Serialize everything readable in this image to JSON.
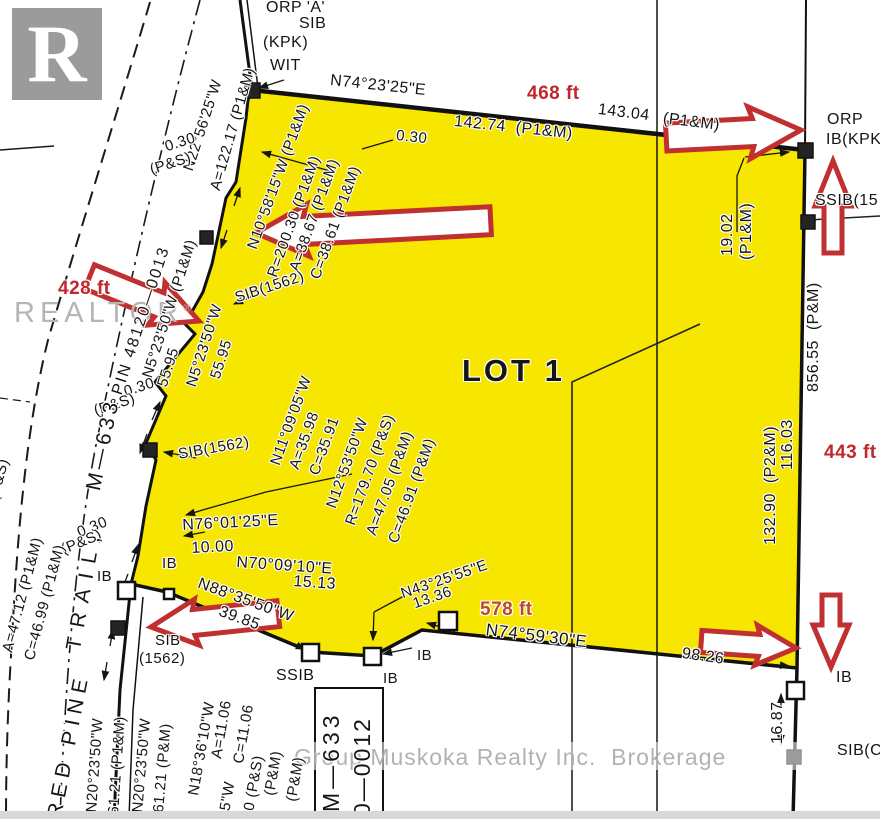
{
  "title": "Survey plan - LOT 1 (Red Pine Trail, M-633)",
  "logo": {
    "letter": "R",
    "brand": "REALTOR",
    "registered": "®"
  },
  "watermark": {
    "text": "Group Muskoka Realty Inc.  Brokerage"
  },
  "colors": {
    "lot_yellow": "#f7e600",
    "arrow_red": "#c13030",
    "dist_red": "#c2272d",
    "dist_orange": "#bd4a22",
    "line_black": "#1a1a1a",
    "watermark_gray": "#aeaeae",
    "logo_gray": "#9b9b9b"
  },
  "icons": [
    "red-arrow-left-top",
    "red-arrow-right-top",
    "red-arrow-up-right",
    "red-arrow-right-428",
    "red-arrow-left-bottom",
    "red-arrow-right-bottom",
    "red-arrow-down-right",
    "realtor-logo"
  ],
  "lot": {
    "name": "LOT 1"
  },
  "labels": [
    {
      "t": "ORP 'A'",
      "x": 266,
      "y": 0,
      "r": 0,
      "s": 16
    },
    {
      "t": "SIB",
      "x": 299,
      "y": 16,
      "r": 0,
      "s": 16
    },
    {
      "t": "(KPK)",
      "x": 263,
      "y": 35,
      "r": 0,
      "s": 16
    },
    {
      "t": "WIT",
      "x": 270,
      "y": 58,
      "r": 0,
      "s": 16
    },
    {
      "t": "N74°23'25\"E",
      "x": 331,
      "y": 73,
      "r": 6,
      "s": 16
    },
    {
      "t": "468 ft",
      "x": 527,
      "y": 84,
      "r": 0,
      "s": 19,
      "w": 700,
      "c": "red"
    },
    {
      "t": "142.74  (P1&M)",
      "x": 455,
      "y": 114,
      "r": 6,
      "s": 16
    },
    {
      "t": "143.04",
      "x": 599,
      "y": 102,
      "r": 7,
      "s": 16
    },
    {
      "t": "(P1&M)",
      "x": 664,
      "y": 111,
      "r": 7,
      "s": 16
    },
    {
      "t": "ORP",
      "x": 827,
      "y": 112,
      "r": 0,
      "s": 16
    },
    {
      "t": "IB(KPK",
      "x": 826,
      "y": 132,
      "r": 0,
      "s": 16
    },
    {
      "t": "SSIB(15",
      "x": 815,
      "y": 193,
      "r": 0,
      "s": 16
    },
    {
      "t": "0.30",
      "x": 397,
      "y": 128,
      "r": 6,
      "s": 15
    },
    {
      "t": "N22°56'25\"W",
      "x": 181,
      "y": 168,
      "r": -72,
      "s": 15
    },
    {
      "t": "A=122.17 (P1&M)",
      "x": 208,
      "y": 188,
      "r": -74,
      "s": 15
    },
    {
      "t": "0.30",
      "x": 163,
      "y": 140,
      "r": -18,
      "s": 15
    },
    {
      "t": "(P&S)",
      "x": 148,
      "y": 163,
      "r": -18,
      "s": 15
    },
    {
      "t": "PIN 48120—0013",
      "x": 110,
      "y": 392,
      "r": -72,
      "s": 16,
      "ls": 2
    },
    {
      "t": "N10°58'15\"W (P1&M)",
      "x": 245,
      "y": 246,
      "r": -70,
      "s": 15
    },
    {
      "t": "R=200.30 (P1&M)",
      "x": 265,
      "y": 274,
      "r": -70,
      "s": 15
    },
    {
      "t": "A=38.67 (P1&M)",
      "x": 287,
      "y": 268,
      "r": -70,
      "s": 15
    },
    {
      "t": "C=38.61 (P1&M)",
      "x": 308,
      "y": 276,
      "r": -70,
      "s": 15
    },
    {
      "t": "SIB(1562)",
      "x": 233,
      "y": 291,
      "r": -18,
      "s": 15
    },
    {
      "t": "428 ft",
      "x": 58,
      "y": 279,
      "r": 0,
      "s": 19,
      "w": 700,
      "c": "red"
    },
    {
      "t": "N5°23'50\"W (P1&M)",
      "x": 140,
      "y": 375,
      "r": -72,
      "s": 15
    },
    {
      "t": "55.95",
      "x": 155,
      "y": 384,
      "r": -72,
      "s": 15
    },
    {
      "t": "N5°23'50\"W",
      "x": 184,
      "y": 384,
      "r": -72,
      "s": 15
    },
    {
      "t": "55.95",
      "x": 208,
      "y": 376,
      "r": -72,
      "s": 15
    },
    {
      "t": "0.30",
      "x": 122,
      "y": 385,
      "r": -18,
      "s": 15
    },
    {
      "t": "(P&S)",
      "x": 92,
      "y": 404,
      "r": -18,
      "s": 15
    },
    {
      "t": "0.30",
      "x": 75,
      "y": 526,
      "r": -22,
      "s": 15
    },
    {
      "t": "(P&S)",
      "x": 59,
      "y": 543,
      "r": -22,
      "s": 15
    },
    {
      "t": "(P&S)",
      "x": -14,
      "y": 498,
      "r": -75,
      "s": 15
    },
    {
      "t": "A=47.12 (P1&M)",
      "x": 0,
      "y": 650,
      "r": -75,
      "s": 15
    },
    {
      "t": "C=46.99 (P1&M)",
      "x": 22,
      "y": 658,
      "r": -75,
      "s": 15
    },
    {
      "t": "RED PINE",
      "x": 44,
      "y": 816,
      "r": -79,
      "s": 21,
      "ls": 6
    },
    {
      "t": "TRAIL,",
      "x": 63,
      "y": 648,
      "r": -80,
      "s": 21,
      "ls": 10
    },
    {
      "t": "M—633",
      "x": 83,
      "y": 488,
      "r": -78,
      "s": 21,
      "ls": 4
    },
    {
      "t": "SIB(1562)",
      "x": 177,
      "y": 447,
      "r": -10,
      "s": 15
    },
    {
      "t": "N11°09'05\"W",
      "x": 268,
      "y": 462,
      "r": -70,
      "s": 15
    },
    {
      "t": "A=35.98",
      "x": 287,
      "y": 466,
      "r": -70,
      "s": 15
    },
    {
      "t": "C=35.91",
      "x": 307,
      "y": 472,
      "r": -70,
      "s": 15
    },
    {
      "t": "N12°53'50\"W",
      "x": 324,
      "y": 505,
      "r": -70,
      "s": 15
    },
    {
      "t": "R=179.70 (P&S)",
      "x": 343,
      "y": 522,
      "r": -70,
      "s": 15
    },
    {
      "t": "A=47.05 (P&M)",
      "x": 364,
      "y": 532,
      "r": -70,
      "s": 15
    },
    {
      "t": "C=46.91 (P&M)",
      "x": 386,
      "y": 540,
      "r": -70,
      "s": 15
    },
    {
      "t": "LOT 1",
      "x": 462,
      "y": 355,
      "r": 0,
      "s": 31,
      "w": 700,
      "ls": 3
    },
    {
      "t": "19.02",
      "x": 720,
      "y": 256,
      "r": -90,
      "s": 16
    },
    {
      "t": "(P1&M)",
      "x": 739,
      "y": 260,
      "r": -90,
      "s": 16
    },
    {
      "t": "856.55  (P&M)",
      "x": 806,
      "y": 392,
      "r": -90,
      "s": 16
    },
    {
      "t": "443 ft",
      "x": 824,
      "y": 443,
      "r": 0,
      "s": 19,
      "w": 700,
      "c": "red"
    },
    {
      "t": "132.90  (P2&M)",
      "x": 763,
      "y": 545,
      "r": -90,
      "s": 16
    },
    {
      "t": "116.03",
      "x": 780,
      "y": 470,
      "r": -90,
      "s": 16
    },
    {
      "t": "N76°01'25\"E",
      "x": 182,
      "y": 518,
      "r": -3,
      "s": 16
    },
    {
      "t": "10.00",
      "x": 191,
      "y": 541,
      "r": -3,
      "s": 16
    },
    {
      "t": "N70°09'10\"E",
      "x": 237,
      "y": 555,
      "r": 4,
      "s": 16
    },
    {
      "t": "15.13",
      "x": 294,
      "y": 574,
      "r": 4,
      "s": 16
    },
    {
      "t": "N88°35'50\"W",
      "x": 201,
      "y": 576,
      "r": 20,
      "s": 16
    },
    {
      "t": "39.85",
      "x": 222,
      "y": 604,
      "r": 20,
      "s": 16
    },
    {
      "t": "N43°25'55\"E",
      "x": 399,
      "y": 587,
      "r": -19,
      "s": 15
    },
    {
      "t": "13.36",
      "x": 411,
      "y": 597,
      "r": -19,
      "s": 15
    },
    {
      "t": "578 ft",
      "x": 480,
      "y": 600,
      "r": 0,
      "s": 19,
      "w": 700,
      "c": "orange"
    },
    {
      "t": "N74°59'30\"E",
      "x": 487,
      "y": 621,
      "r": 7,
      "s": 17
    },
    {
      "t": "98.26",
      "x": 683,
      "y": 646,
      "r": 8,
      "s": 16
    },
    {
      "t": "IB",
      "x": 97,
      "y": 569,
      "r": 0,
      "s": 15
    },
    {
      "t": "IB",
      "x": 162,
      "y": 556,
      "r": 0,
      "s": 15
    },
    {
      "t": "SIB",
      "x": 155,
      "y": 633,
      "r": 0,
      "s": 15
    },
    {
      "t": "(1562)",
      "x": 139,
      "y": 651,
      "r": 0,
      "s": 15
    },
    {
      "t": "SSIB",
      "x": 276,
      "y": 668,
      "r": 0,
      "s": 16
    },
    {
      "t": "IB",
      "x": 383,
      "y": 671,
      "r": 0,
      "s": 15
    },
    {
      "t": "IB",
      "x": 417,
      "y": 648,
      "r": 0,
      "s": 15
    },
    {
      "t": "IB",
      "x": 836,
      "y": 670,
      "r": 0,
      "s": 16
    },
    {
      "t": "16.87",
      "x": 770,
      "y": 744,
      "r": -90,
      "s": 16
    },
    {
      "t": "SIB(C",
      "x": 837,
      "y": 743,
      "r": 0,
      "s": 16
    },
    {
      "t": "N20°23'50\"W",
      "x": 84,
      "y": 812,
      "r": -86,
      "s": 15
    },
    {
      "t": "61.21 (P1&M)",
      "x": 106,
      "y": 814,
      "r": -86,
      "s": 15
    },
    {
      "t": "N20°23'50\"W",
      "x": 130,
      "y": 812,
      "r": -85,
      "s": 15
    },
    {
      "t": "61.21 (P&M)",
      "x": 151,
      "y": 812,
      "r": -85,
      "s": 15
    },
    {
      "t": "N18°36'10\"W",
      "x": 186,
      "y": 794,
      "r": -80,
      "s": 15
    },
    {
      "t": "A=11.06",
      "x": 209,
      "y": 757,
      "r": -80,
      "s": 15
    },
    {
      "t": "C=11.06",
      "x": 231,
      "y": 762,
      "r": -80,
      "s": 15
    },
    {
      "t": "35\"W",
      "x": 216,
      "y": 818,
      "r": -80,
      "s": 15
    },
    {
      "t": "70 (P&S)",
      "x": 240,
      "y": 818,
      "r": -80,
      "s": 15
    },
    {
      "t": "(P&M)",
      "x": 262,
      "y": 794,
      "r": -80,
      "s": 15
    },
    {
      "t": "(P&M)",
      "x": 284,
      "y": 800,
      "r": -80,
      "s": 15
    },
    {
      "t": "M—633",
      "x": 320,
      "y": 812,
      "r": -90,
      "s": 23,
      "ls": 4
    },
    {
      "t": "0—0012",
      "x": 351,
      "y": 816,
      "r": -90,
      "s": 23,
      "ls": 2
    }
  ]
}
